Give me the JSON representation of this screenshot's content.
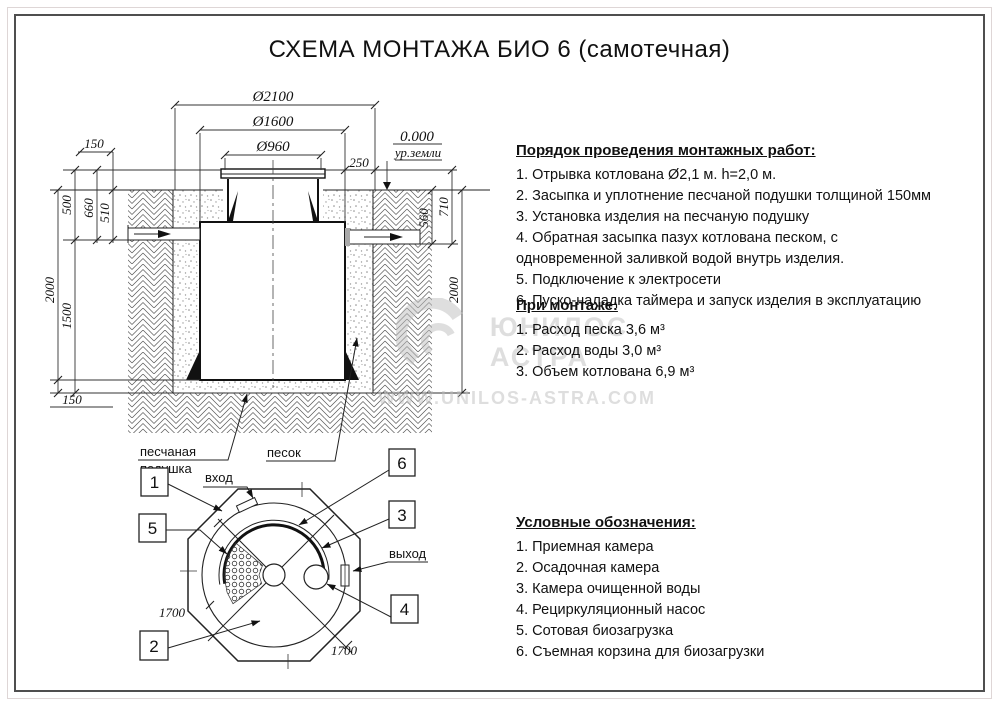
{
  "title": "СХЕМА МОНТАЖА БИО 6 (самотечная)",
  "cross_section": {
    "dia_pit": "Ø2100",
    "dia_tank": "Ø1600",
    "dia_neck": "Ø960",
    "level_zero": "0.000",
    "level_ground": "ур.земли",
    "dim_250": "250",
    "dim_150_top": "150",
    "dim_500": "500",
    "dim_660": "660",
    "dim_510": "510",
    "dim_2000_left": "2000",
    "dim_1500": "1500",
    "dim_150_bottom": "150",
    "dim_560": "560",
    "dim_710": "710",
    "dim_2000_right": "2000",
    "label_sand_cushion_line1": "песчаная",
    "label_sand_cushion_line2": "подушка",
    "label_sand": "песок"
  },
  "plan": {
    "label_inlet": "вход",
    "label_outlet": "выход",
    "dim_1700_left": "1700",
    "dim_1700_bottom": "1700",
    "callout_1": "1",
    "callout_2": "2",
    "callout_3": "3",
    "callout_4": "4",
    "callout_5": "5",
    "callout_6": "6"
  },
  "sections": {
    "install": {
      "heading": "Порядок проведения монтажных работ:",
      "items": [
        "1. Отрывка котлована Ø2,1 м. h=2,0 м.",
        "2. Засыпка и уплотнение песчаной подушки толщиной 150мм",
        "3. Установка изделия на песчаную подушку",
        "4. Обратная засыпка пазух котлована песком, с одновременной заливкой водой внутрь изделия.",
        "5. Подключение к электросети",
        "6. Пуско-наладка таймера и запуск изделия в эксплуатацию"
      ]
    },
    "montage": {
      "heading": "При монтаже:",
      "items": [
        "1. Расход песка 3,6 м³",
        "2. Расход воды 3,0 м³",
        "3. Объем котлована 6,9 м³"
      ]
    },
    "legend": {
      "heading": "Условные обозначения:",
      "items": [
        "1. Приемная камера",
        "2. Осадочная камера",
        "3. Камера очищенной воды",
        "4. Рециркуляционный насос",
        "5. Сотовая биозагрузка",
        "6. Съемная корзина для биозагрузки"
      ]
    }
  },
  "watermark": {
    "brand_line1": "ЮНИЛОС",
    "brand_line2": "АСТРА",
    "url": "WWW.UNILOS-ASTRA.COM"
  }
}
